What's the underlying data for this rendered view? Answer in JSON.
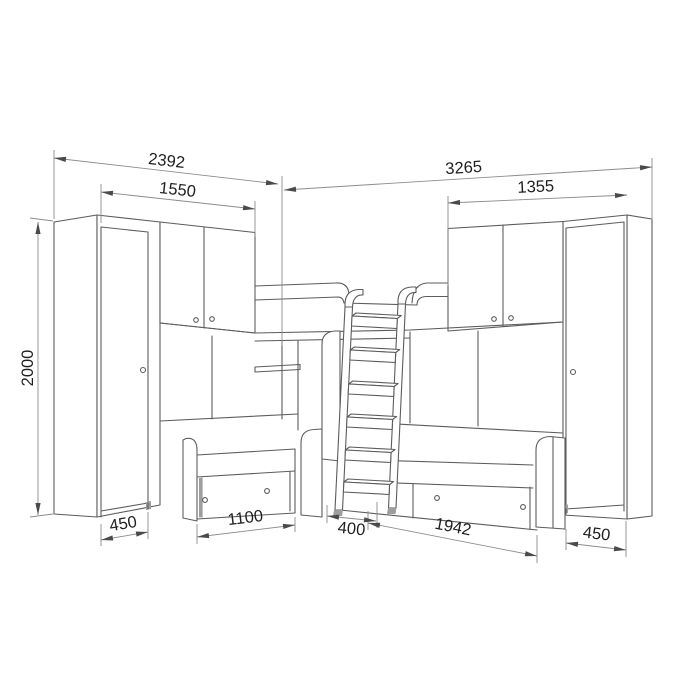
{
  "drawing": {
    "subject": "corner children bunk-bed furniture set technical drawing",
    "description": "line drawing of two tall wardrobes, two overhead cabinets, corner top bunk with ladder, and two lower beds with drawers, annotated with millimeter dimensions",
    "unit": "mm",
    "colors": {
      "background": "#ffffff",
      "furniture_line": "#5c5c5c",
      "dimension_line": "#8c8c8c",
      "text": "#1f1f1f",
      "shaded_edge": "#9e9e9e"
    },
    "dimensions": [
      {
        "id": "left-unit-width",
        "value": "2392",
        "x1": 54,
        "y1": 158,
        "x2": 278,
        "y2": 184,
        "lx": 166,
        "ly": 166,
        "rot": 6.6
      },
      {
        "id": "right-unit-width",
        "value": "3265",
        "x1": 284,
        "y1": 190,
        "x2": 652,
        "y2": 167,
        "lx": 464,
        "ly": 173,
        "rot": -3.6
      },
      {
        "id": "left-cabinet-width",
        "value": "1550",
        "x1": 101,
        "y1": 192,
        "x2": 255,
        "y2": 209,
        "lx": 177,
        "ly": 195,
        "rot": 6.3
      },
      {
        "id": "right-cabinet-width",
        "value": "1355",
        "x1": 448,
        "y1": 203,
        "x2": 627,
        "y2": 195,
        "lx": 536,
        "ly": 192,
        "rot": -2.6
      },
      {
        "id": "overall-height",
        "value": "2000",
        "x1": 38,
        "y1": 222,
        "x2": 38,
        "y2": 515,
        "lx": 33,
        "ly": 368,
        "rot": -90
      },
      {
        "id": "left-wardrobe-depth",
        "value": "450",
        "x1": 101,
        "y1": 540,
        "x2": 148,
        "y2": 532,
        "lx": 124,
        "ly": 529,
        "rot": -9.6
      },
      {
        "id": "left-bed-drawer-width",
        "value": "1100",
        "x1": 197,
        "y1": 537,
        "x2": 295,
        "y2": 525,
        "lx": 246,
        "ly": 523,
        "rot": -7
      },
      {
        "id": "ladder-width",
        "value": "400",
        "x1": 327,
        "y1": 516,
        "x2": 376,
        "y2": 521,
        "lx": 351,
        "ly": 534,
        "rot": 5.8
      },
      {
        "id": "right-bed-drawer-width",
        "value": "1942",
        "x1": 368,
        "y1": 523,
        "x2": 537,
        "y2": 556,
        "lx": 452,
        "ly": 532,
        "rot": 11.1
      },
      {
        "id": "right-wardrobe-depth",
        "value": "450",
        "x1": 566,
        "y1": 543,
        "x2": 626,
        "y2": 550,
        "lx": 596,
        "ly": 539,
        "rot": 6.7
      }
    ]
  }
}
